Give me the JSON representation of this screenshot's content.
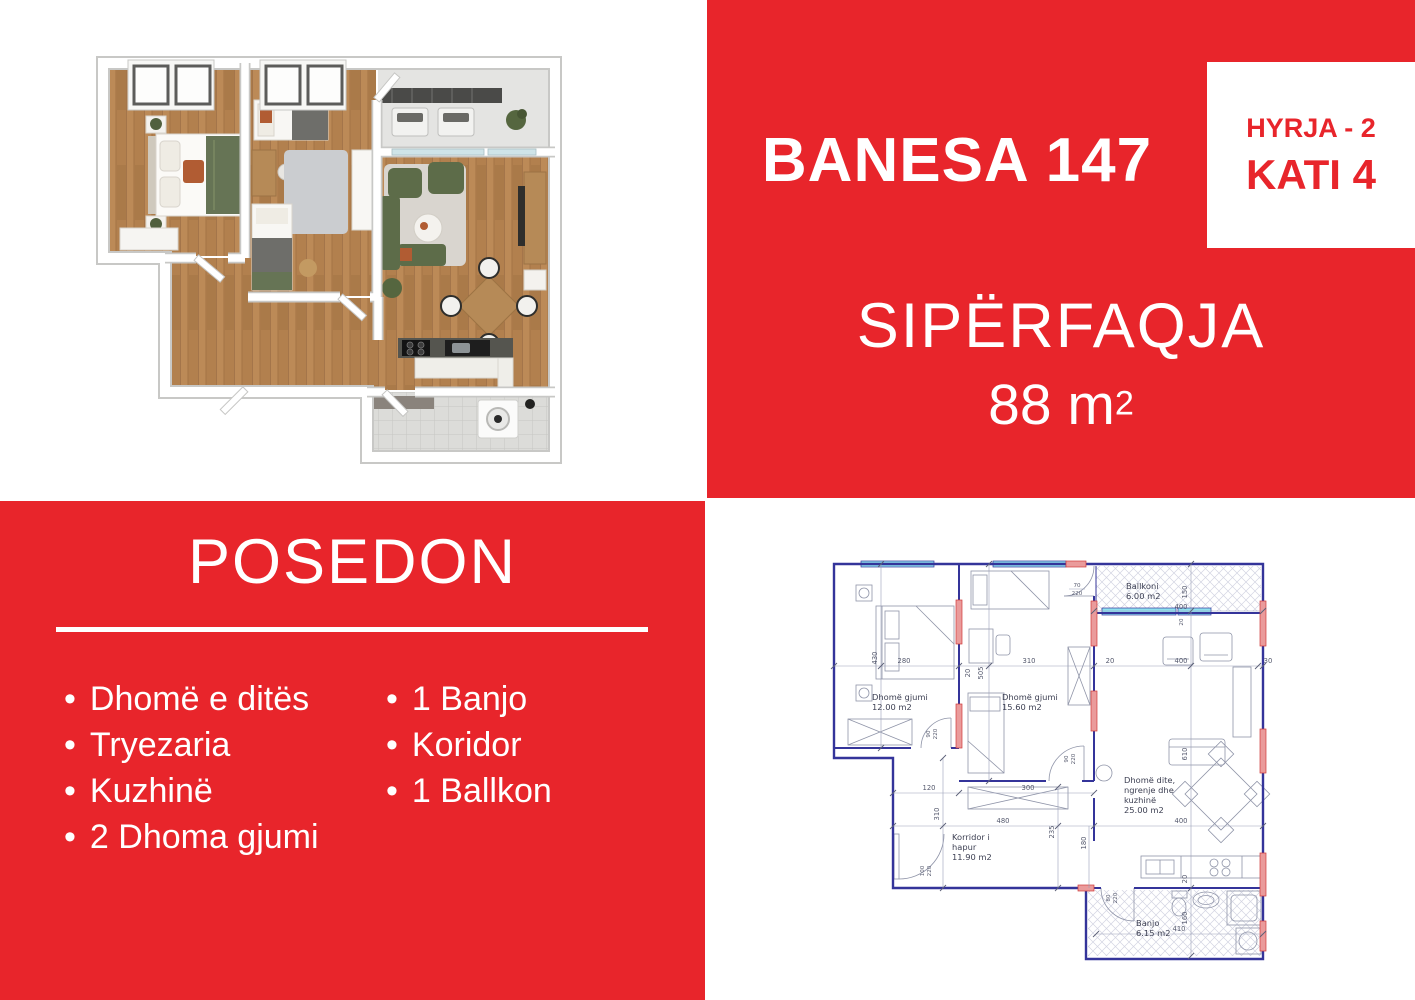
{
  "palette": {
    "red": "#e8252b",
    "wall_blue": "#34349a"
  },
  "header": {
    "title": "BANESA 147",
    "entry_label": "HYRJA - 2",
    "floor_label": "KATI 4",
    "area_label": "SIPËRFAQJA",
    "area_value": "88 m",
    "area_sup": "2"
  },
  "features": {
    "title": "POSEDON",
    "bullet": "•",
    "col1": [
      "Dhomë e ditës",
      "Tryezaria",
      "Kuzhinë",
      "2 Dhoma gjumi"
    ],
    "col2": [
      "1 Banjo",
      "Koridor",
      "1 Ballkon"
    ]
  },
  "floor_plan": {
    "bedroom1": {
      "name": "Dhomë gjumi",
      "area": "12.00 m2"
    },
    "bedroom2": {
      "name": "Dhomë gjumi",
      "area": "15.60 m2"
    },
    "balcony": {
      "name": "Ballkoni",
      "area": "6.00 m2"
    },
    "living": {
      "line1": "Dhomë dite,",
      "line2": "ngrenje dhe",
      "line3": "kuzhinë",
      "area": "25.00 m2"
    },
    "corridor": {
      "line1": "Korridor i",
      "line2": "hapur",
      "area": "11.90 m2"
    },
    "bath": {
      "name": "Banjo",
      "area": "6.15 m2"
    },
    "dims": {
      "b1w": "280",
      "b1h": "430",
      "wall20": "20",
      "b2h": "505",
      "b2w": "310",
      "gap20": "20",
      "livw": "400",
      "edge30": "30",
      "balh": "150",
      "balw": "400",
      "balwin20": "20",
      "door70": "70",
      "door70h": "220",
      "door90a": "90",
      "door90ah": "220",
      "door90b": "90",
      "door90bh": "220",
      "ward": "300",
      "cor120": "120",
      "cor310": "310",
      "cor480": "480",
      "cor235": "235",
      "pass180": "180",
      "livw2": "400",
      "livh": "610",
      "entry100": "100",
      "entry100h": "220",
      "bath80": "80",
      "bath80h": "220",
      "kit20": "20",
      "bath160": "160",
      "bath410": "410"
    }
  }
}
